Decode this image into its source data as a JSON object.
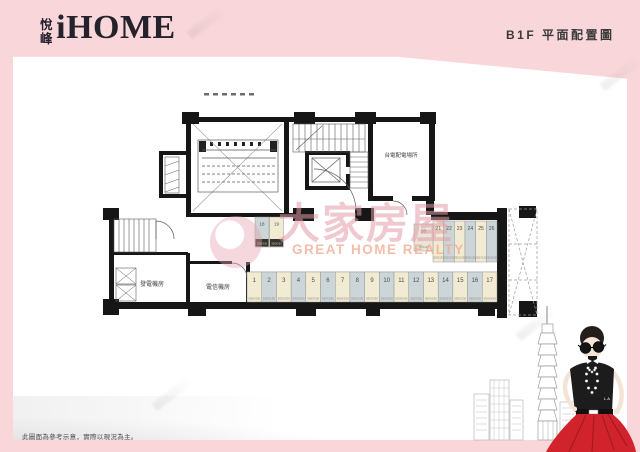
{
  "header": {
    "brand_cn": "悅峰",
    "brand_en": "iHOME",
    "page_title": "B1F 平面配置圖"
  },
  "plan": {
    "room_labels": {
      "taipower": "台電配電場所",
      "generator": "發電機房",
      "telecom": "電信機房"
    },
    "parking": {
      "main_row": [
        "1",
        "2",
        "3",
        "4",
        "5",
        "6",
        "7",
        "8",
        "9",
        "10",
        "11",
        "12",
        "13",
        "14",
        "15",
        "16",
        "17"
      ],
      "upper_row": [
        "21",
        "22",
        "23",
        "24",
        "25",
        "26"
      ],
      "small_pair": [
        "18",
        "19"
      ],
      "single": "20",
      "dim_label": "550X230"
    },
    "colors": {
      "wall": "#161616",
      "stall_cream": "#f2ebd3",
      "stall_gray": "#ccd6d9",
      "stall_light": "#e9e5da"
    }
  },
  "watermark": {
    "cn": "大家房屋",
    "en": "GREAT HOME REALTY",
    "color_cn": "#e29baa",
    "color_en": "#f2a78c"
  },
  "footer": {
    "disclaimer": "此圖面為參考示意，實際以現況為主。"
  },
  "art": {
    "shirt_text": "LA",
    "skirt_color": "#d0232c"
  },
  "frame": {
    "pink": "#f8d6da"
  }
}
